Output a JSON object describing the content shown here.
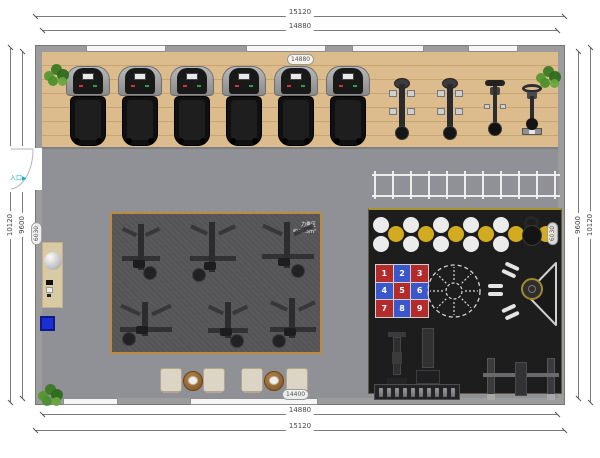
{
  "plan_title": "gym-floor-plan",
  "dimensions": {
    "top_outer": "15120",
    "top_inner": "14880",
    "bottom_inner": "14880",
    "bottom_outer": "15120",
    "left_outer": "10120",
    "left_inner": "9600",
    "right_inner": "9600",
    "right_outer": "10120"
  },
  "floor_labels": {
    "top": "14880",
    "bottom": "14400",
    "left_wall": "6030",
    "right_wall": "6030"
  },
  "entrance": {
    "label": "入口",
    "arrow": "▶",
    "color": "#14b0c0"
  },
  "zones": {
    "cardio": {
      "treadmills": 6,
      "ellipticals": 2,
      "spin_bikes": 1,
      "upright_bikes": 1
    },
    "strength": {
      "machines": 6,
      "label_line1": "力量区",
      "label_line2": "约47.5m²"
    },
    "functional": {
      "white_ball_pairs": 5,
      "yellow_balls": 6,
      "battle_grid_numbers": [
        "1",
        "2",
        "3",
        "4",
        "5",
        "6",
        "7",
        "8",
        "9"
      ],
      "battle_grid_colors": [
        "#b32b2b",
        "#3a57cc",
        "#b32b2b",
        "#3a57cc",
        "#b32b2b",
        "#3a57cc",
        "#b32b2b",
        "#3a57cc",
        "#b32b2b"
      ],
      "dumbbell_rack_slots": 10,
      "dumbbell_pairs": 3
    },
    "agility_ladder": {
      "rungs": 11
    }
  },
  "furniture": {
    "stools": 4,
    "round_tables": 2,
    "plants": 3
  },
  "colors": {
    "wall": "#9c9c9c",
    "window": "#f6f6f6",
    "wood_floor": "#dcbc8c",
    "gray_floor": "#8f9196",
    "strength_bg": "#59595b",
    "strength_border": "#c08a3e",
    "functional_bg": "#1d1d1d",
    "ball_white": "#ebebeb",
    "ball_yellow": "#d2ab20",
    "grid_red": "#b32b2b",
    "grid_blue": "#3a57cc",
    "reception_mat": "#d9caa6",
    "locker_blue": "#1c2fd4",
    "plant_green": "#4a8f2c"
  }
}
